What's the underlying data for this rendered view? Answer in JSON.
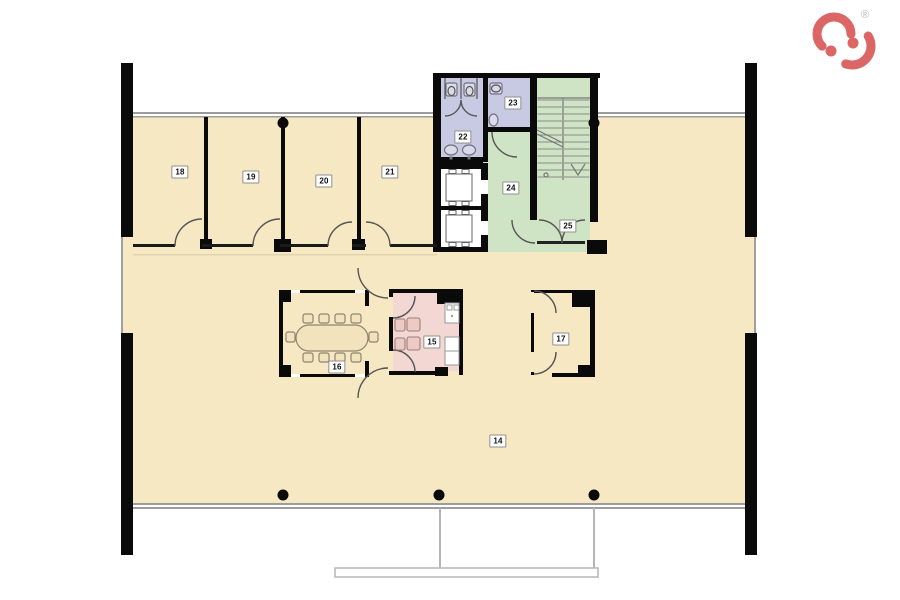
{
  "logo": {
    "registered_mark": "®"
  },
  "colors": {
    "floor": "#f7e8c4",
    "wc": "#c8c9e3",
    "stairs": "#cfe4c5",
    "kitchen": "#f3d7d2",
    "wall": "#0a0a0a",
    "facade": "#9c9c9c",
    "logo": "#dc6565"
  },
  "rooms": [
    {
      "number": "14"
    },
    {
      "number": "15"
    },
    {
      "number": "16"
    },
    {
      "number": "17"
    },
    {
      "number": "18"
    },
    {
      "number": "19"
    },
    {
      "number": "20"
    },
    {
      "number": "21"
    },
    {
      "number": "22"
    },
    {
      "number": "23"
    },
    {
      "number": "24"
    },
    {
      "number": "25"
    }
  ]
}
